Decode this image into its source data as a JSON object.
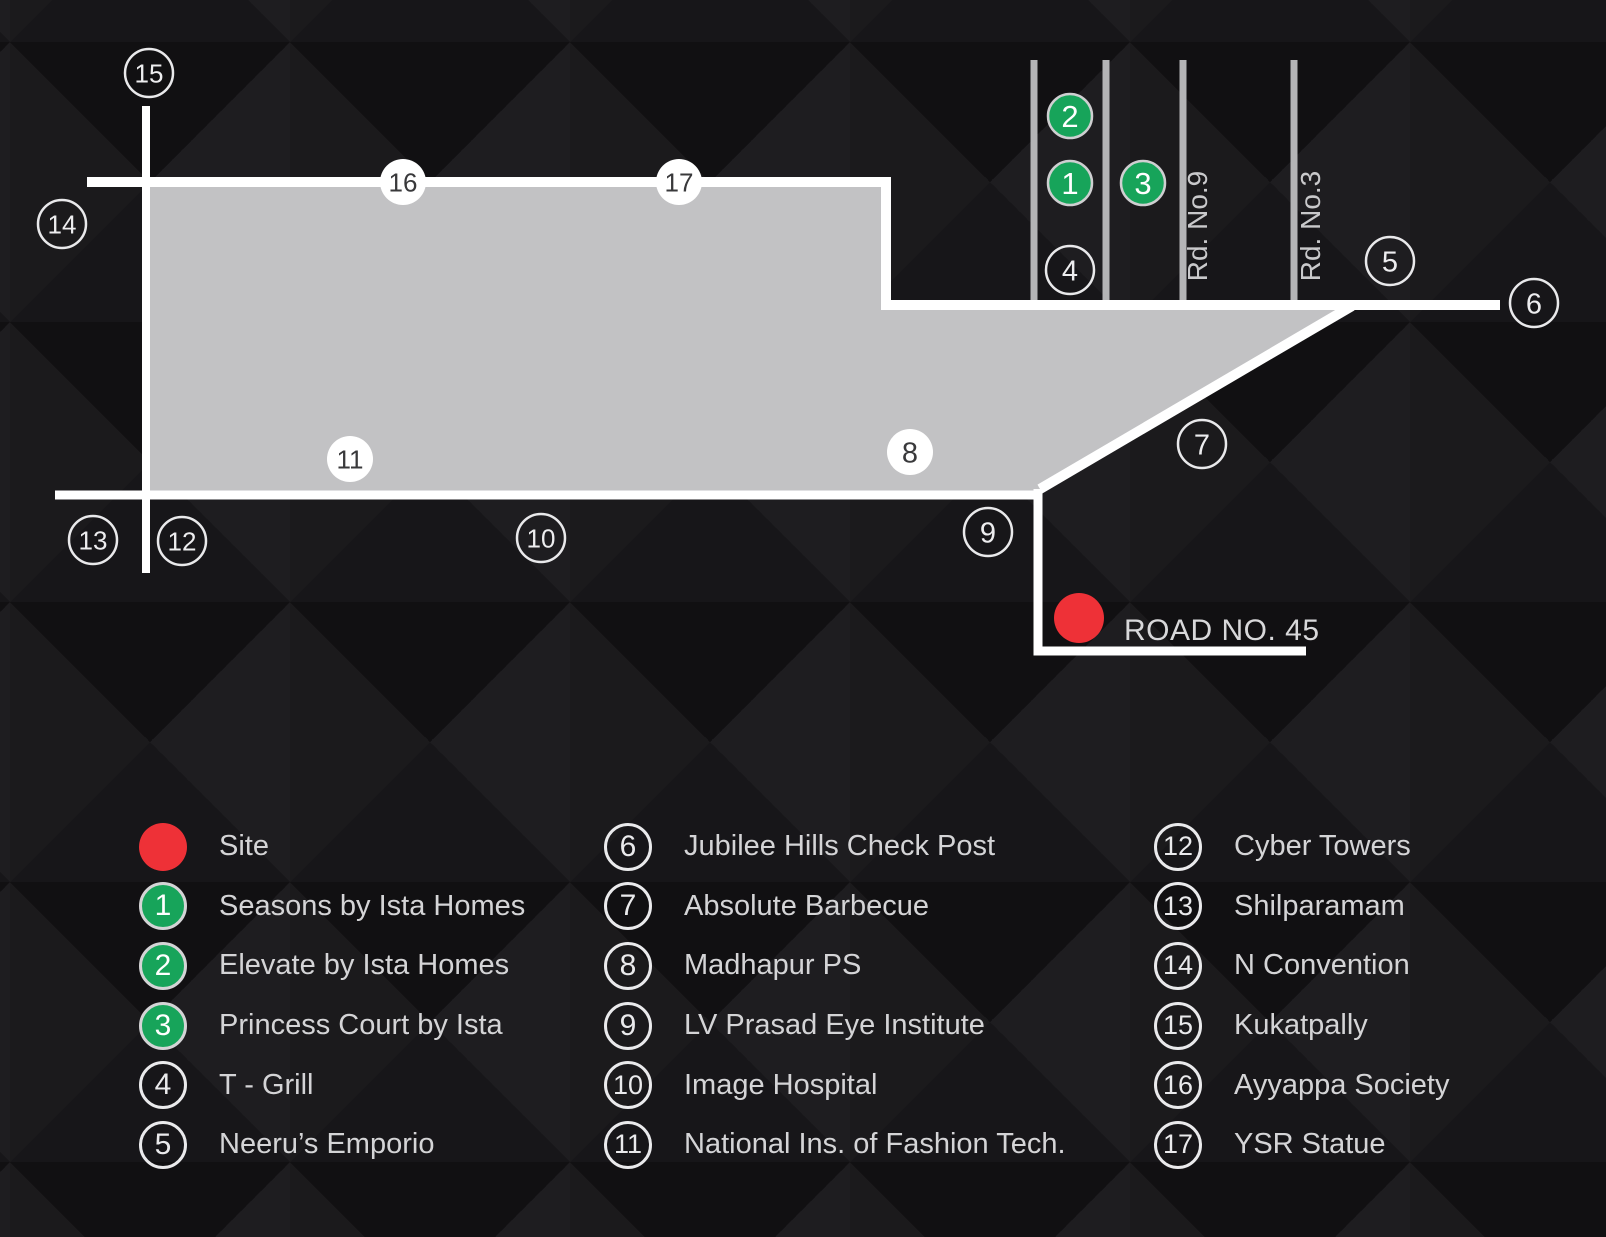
{
  "map": {
    "road45_label": "ROAD NO. 45",
    "rd9_label": "Rd. No.9",
    "rd3_label": "Rd. No.3",
    "colors": {
      "site_red": "#ee3137",
      "marker_green": "#17a45a",
      "land_gray": "#c2c2c4",
      "road_white": "#ffffff",
      "side_road_gray": "#b4b4b6",
      "text_light": "#d4d4d6"
    },
    "markers": [
      {
        "number": "15",
        "type": "outline",
        "x": 149,
        "y": 73
      },
      {
        "number": "14",
        "type": "outline",
        "x": 62,
        "y": 224
      },
      {
        "number": "16",
        "type": "filled",
        "x": 403,
        "y": 182
      },
      {
        "number": "17",
        "type": "filled",
        "x": 679,
        "y": 182
      },
      {
        "number": "13",
        "type": "outline",
        "x": 93,
        "y": 540
      },
      {
        "number": "12",
        "type": "outline",
        "x": 182,
        "y": 541
      },
      {
        "number": "11",
        "type": "filled",
        "x": 350,
        "y": 459
      },
      {
        "number": "10",
        "type": "outline",
        "x": 541,
        "y": 538
      },
      {
        "number": "8",
        "type": "filled",
        "x": 910,
        "y": 452
      },
      {
        "number": "9",
        "type": "outline",
        "x": 988,
        "y": 532
      },
      {
        "number": "7",
        "type": "outline",
        "x": 1202,
        "y": 444
      },
      {
        "number": "4",
        "type": "outline",
        "x": 1070,
        "y": 270
      },
      {
        "number": "5",
        "type": "outline",
        "x": 1390,
        "y": 261
      },
      {
        "number": "6",
        "type": "outline",
        "x": 1534,
        "y": 303
      },
      {
        "number": "2",
        "type": "green",
        "x": 1070,
        "y": 116
      },
      {
        "number": "1",
        "type": "green",
        "x": 1070,
        "y": 183
      },
      {
        "number": "3",
        "type": "green",
        "x": 1143,
        "y": 183
      },
      {
        "number": "",
        "type": "site",
        "x": 1079,
        "y": 618
      }
    ]
  },
  "legend": {
    "columns": [
      {
        "items": [
          {
            "type": "site",
            "number": "",
            "label": "Site"
          },
          {
            "type": "green",
            "number": "1",
            "label": "Seasons by Ista Homes"
          },
          {
            "type": "green",
            "number": "2",
            "label": "Elevate by Ista Homes"
          },
          {
            "type": "green",
            "number": "3",
            "label": "Princess Court by Ista"
          },
          {
            "type": "outline",
            "number": "4",
            "label": "T - Grill"
          },
          {
            "type": "outline",
            "number": "5",
            "label": "Neeru’s Emporio"
          }
        ]
      },
      {
        "items": [
          {
            "type": "outline",
            "number": "6",
            "label": "Jubilee Hills Check Post"
          },
          {
            "type": "outline",
            "number": "7",
            "label": "Absolute Barbecue"
          },
          {
            "type": "outline",
            "number": "8",
            "label": "Madhapur PS"
          },
          {
            "type": "outline",
            "number": "9",
            "label": "LV Prasad Eye Institute"
          },
          {
            "type": "outline",
            "number": "10",
            "label": "Image Hospital"
          },
          {
            "type": "outline",
            "number": "11",
            "label": "National Ins. of Fashion Tech."
          }
        ]
      },
      {
        "items": [
          {
            "type": "outline",
            "number": "12",
            "label": "Cyber Towers"
          },
          {
            "type": "outline",
            "number": "13",
            "label": "Shilparamam"
          },
          {
            "type": "outline",
            "number": "14",
            "label": "N Convention"
          },
          {
            "type": "outline",
            "number": "15",
            "label": "Kukatpally"
          },
          {
            "type": "outline",
            "number": "16",
            "label": "Ayyappa Society"
          },
          {
            "type": "outline",
            "number": "17",
            "label": "YSR Statue"
          }
        ]
      }
    ]
  }
}
